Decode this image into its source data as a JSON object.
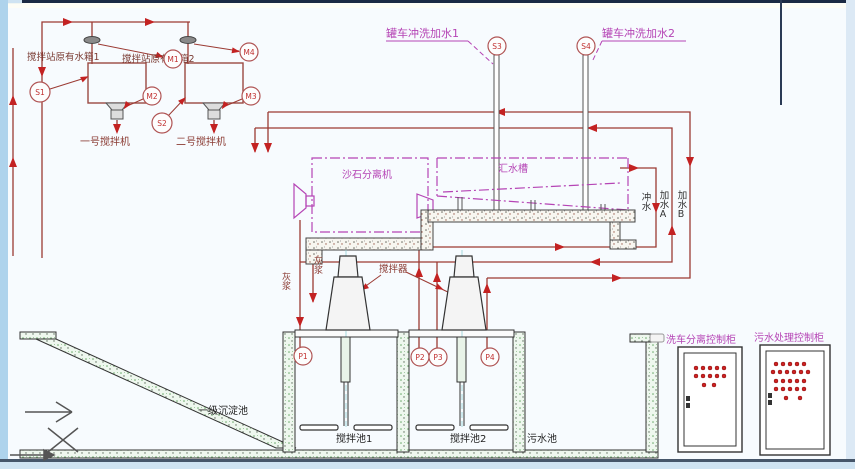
{
  "diagram_title": "搅拌站洗车/污水处理工艺流程图",
  "colors": {
    "pipe": "#9b3a33",
    "arrow": "#c32222",
    "magenta": "#b544b5",
    "structure_black": "#333333",
    "circle_stroke": "#b05555",
    "circle_text": "#c03030",
    "frame_top": "#1b2a44",
    "frame_left_strip": "#aed3ec",
    "frame_bottom_strip": "#cfe3f2"
  },
  "tanks": {
    "tank1_label": "搅拌站原有水箱1",
    "tank2_label": "搅拌站原有水箱2",
    "mixer1_label": "一号搅拌机",
    "mixer2_label": "二号搅拌机"
  },
  "top_right": {
    "truck_wash1": "罐车冲洗加水1",
    "truck_wash2": "罐车冲洗加水2"
  },
  "machines": {
    "sand_separator": "沙石分离机",
    "water_trough": "汇水槽",
    "agitator": "搅拌器"
  },
  "pipe_labels": {
    "flush_water": "冲水",
    "add_water_a": "加水A",
    "add_water_b": "加水B",
    "slurry_a": "灰浆",
    "slurry_b": "灰浆"
  },
  "pools": {
    "sedimentation": "一级沉淀池",
    "mixing_pool1": "搅拌池1",
    "mixing_pool2": "搅拌池2",
    "sewage_pool": "污水池"
  },
  "cabinets": {
    "cabinet1_label": "洗车分离控制柜",
    "cabinet2_label": "污水处理控制柜"
  },
  "sensors": {
    "s1": "S1",
    "s2": "S2",
    "s3": "S3",
    "s4": "S4",
    "m1": "M1",
    "m2": "M2",
    "m3": "M3",
    "m4": "M4",
    "p1": "P1",
    "p2": "P2",
    "p3": "P3",
    "p4": "P4"
  }
}
